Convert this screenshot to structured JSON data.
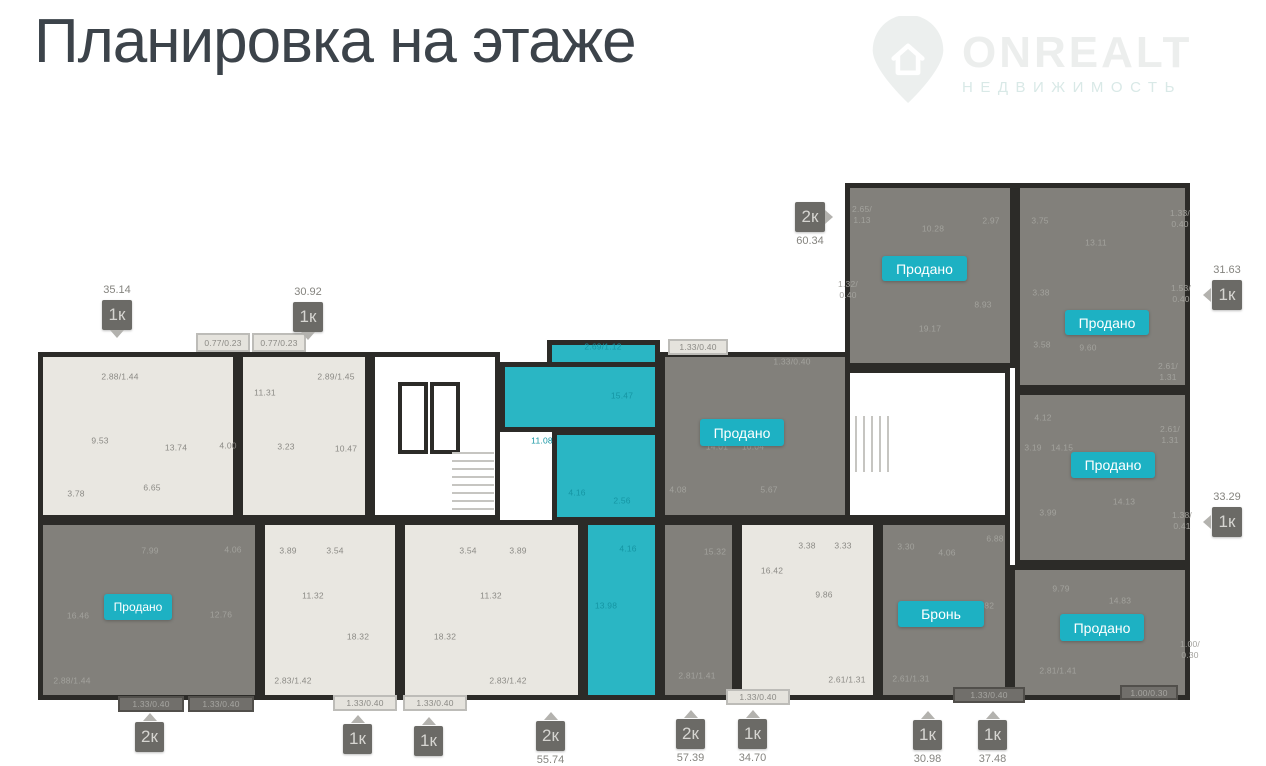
{
  "header": {
    "title": "Планировка на этаже"
  },
  "logo": {
    "brand": "ONREALT",
    "subtitle": "НЕДВИЖИМОСТЬ",
    "icon": "house-pin-icon"
  },
  "palette": {
    "accent_teal": "#1db1c3",
    "apartment_highlight": "#2ab6c4",
    "wall": "#2c2b28",
    "apartment_light": "#e9e7e1",
    "apartment_sold": "#82807b",
    "badge_dark": "#6b6a66",
    "title_color": "#3c434a"
  },
  "plan": {
    "blocks": [
      {
        "n": "apartment-1k-35-14",
        "f": "light",
        "i": 1,
        "x": 38,
        "y": 352,
        "w": 200,
        "h": 168
      },
      {
        "n": "apartment-1k-30-92",
        "f": "light",
        "i": 1,
        "x": 238,
        "y": 352,
        "w": 132,
        "h": 168
      },
      {
        "n": "stairwell-left",
        "f": "white",
        "i": 0,
        "x": 370,
        "y": 352,
        "w": 130,
        "h": 168
      },
      {
        "n": "apartment-2k-57-39-upper",
        "f": "dark",
        "i": 1,
        "x": 660,
        "y": 352,
        "w": 190,
        "h": 168
      },
      {
        "n": "corridor-left",
        "f": "white",
        "i": 0,
        "x": 850,
        "y": 352,
        "w": 30,
        "h": 168
      },
      {
        "n": "apartment-2k-sold-bottom-left",
        "f": "dark",
        "i": 1,
        "x": 38,
        "y": 520,
        "w": 222,
        "h": 180
      },
      {
        "n": "apartment-1k-bottom-a",
        "f": "light",
        "i": 1,
        "x": 260,
        "y": 520,
        "w": 140,
        "h": 180
      },
      {
        "n": "apartment-1k-bottom-b",
        "f": "light",
        "i": 1,
        "x": 400,
        "y": 520,
        "w": 183,
        "h": 180
      },
      {
        "n": "apartment-2k-57-39-lower",
        "f": "dark",
        "i": 1,
        "x": 660,
        "y": 520,
        "w": 77,
        "h": 180
      },
      {
        "n": "apartment-1k-34-70",
        "f": "light",
        "i": 1,
        "x": 737,
        "y": 520,
        "w": 141,
        "h": 180
      },
      {
        "n": "apartment-2k-55-74-top",
        "f": "teal",
        "i": 1,
        "x": 547,
        "y": 340,
        "w": 113,
        "h": 34
      },
      {
        "n": "apartment-2k-55-74-upper",
        "f": "teal",
        "i": 1,
        "x": 500,
        "y": 362,
        "w": 160,
        "h": 70
      },
      {
        "n": "apartment-2k-55-74-mid",
        "f": "teal",
        "i": 1,
        "x": 552,
        "y": 430,
        "w": 108,
        "h": 92
      },
      {
        "n": "apartment-2k-55-74-lower",
        "f": "teal",
        "i": 1,
        "x": 583,
        "y": 520,
        "w": 77,
        "h": 180
      },
      {
        "n": "apartment-2k-60-34",
        "f": "dark",
        "i": 1,
        "x": 845,
        "y": 183,
        "w": 170,
        "h": 185
      },
      {
        "n": "stairwell-right",
        "f": "white",
        "i": 0,
        "x": 845,
        "y": 368,
        "w": 165,
        "h": 152
      },
      {
        "n": "apartment-1k-31-63",
        "f": "dark",
        "i": 1,
        "x": 1015,
        "y": 183,
        "w": 175,
        "h": 207
      },
      {
        "n": "apartment-1k-33-29",
        "f": "dark",
        "i": 1,
        "x": 1015,
        "y": 390,
        "w": 175,
        "h": 175
      },
      {
        "n": "apartment-1k-30-98-reserved",
        "f": "dark",
        "i": 1,
        "x": 878,
        "y": 520,
        "w": 132,
        "h": 180
      },
      {
        "n": "apartment-1k-37-48",
        "f": "dark",
        "i": 1,
        "x": 1010,
        "y": 565,
        "w": 180,
        "h": 135
      }
    ],
    "balcony_boxes": [
      {
        "t": "0.77/0.23",
        "f": "lightbox",
        "x": 196,
        "y": 333,
        "w": 54,
        "h": 19
      },
      {
        "t": "0.77/0.23",
        "f": "lightbox",
        "x": 252,
        "y": 333,
        "w": 54,
        "h": 19
      },
      {
        "t": "1.33/0.40",
        "f": "lightbox",
        "x": 668,
        "y": 339,
        "w": 60,
        "h": 16
      },
      {
        "t": "1.33/0.40",
        "f": "darkbox",
        "x": 118,
        "y": 696,
        "w": 66,
        "h": 16
      },
      {
        "t": "1.33/0.40",
        "f": "darkbox",
        "x": 188,
        "y": 696,
        "w": 66,
        "h": 16
      },
      {
        "t": "1.33/0.40",
        "f": "lightbox",
        "x": 333,
        "y": 695,
        "w": 64,
        "h": 16
      },
      {
        "t": "1.33/0.40",
        "f": "lightbox",
        "x": 403,
        "y": 695,
        "w": 64,
        "h": 16
      },
      {
        "t": "1.33/0.40",
        "f": "lightbox",
        "x": 726,
        "y": 689,
        "w": 64,
        "h": 16
      },
      {
        "t": "1.33/0.40",
        "f": "darkbox",
        "x": 953,
        "y": 687,
        "w": 72,
        "h": 16
      },
      {
        "t": "1.00/0.30",
        "f": "darkbox",
        "x": 1120,
        "y": 685,
        "w": 58,
        "h": 15
      }
    ],
    "rooms": [
      {
        "t": "2.88/1.44",
        "x": 120,
        "y": 377,
        "tn": "d"
      },
      {
        "t": "9.53",
        "x": 100,
        "y": 441,
        "tn": "d"
      },
      {
        "t": "13.74",
        "x": 176,
        "y": 448,
        "tn": "d"
      },
      {
        "t": "3.78",
        "x": 76,
        "y": 494,
        "tn": "d"
      },
      {
        "t": "6.65",
        "x": 152,
        "y": 488,
        "tn": "d"
      },
      {
        "t": "11.31",
        "x": 265,
        "y": 393,
        "tn": "d"
      },
      {
        "t": "4.00",
        "x": 228,
        "y": 446,
        "tn": "d"
      },
      {
        "t": "3.23",
        "x": 286,
        "y": 447,
        "tn": "d"
      },
      {
        "t": "2.89/1.45",
        "x": 336,
        "y": 377,
        "tn": "d"
      },
      {
        "t": "10.47",
        "x": 346,
        "y": 449,
        "tn": "d"
      },
      {
        "t": "16.46",
        "x": 78,
        "y": 616,
        "tn": "l"
      },
      {
        "t": "7.99",
        "x": 150,
        "y": 551,
        "tn": "l"
      },
      {
        "t": "12.76",
        "x": 221,
        "y": 615,
        "tn": "l"
      },
      {
        "t": "4.06",
        "x": 233,
        "y": 550,
        "tn": "l"
      },
      {
        "t": "2.88/1.44",
        "x": 72,
        "y": 681,
        "tn": "l"
      },
      {
        "t": "3.89",
        "x": 288,
        "y": 551,
        "tn": "d"
      },
      {
        "t": "3.54",
        "x": 335,
        "y": 551,
        "tn": "d"
      },
      {
        "t": "11.32",
        "x": 313,
        "y": 596,
        "tn": "d"
      },
      {
        "t": "18.32",
        "x": 358,
        "y": 637,
        "tn": "d"
      },
      {
        "t": "2.83/1.42",
        "x": 293,
        "y": 681,
        "tn": "d"
      },
      {
        "t": "3.54",
        "x": 468,
        "y": 551,
        "tn": "d"
      },
      {
        "t": "3.89",
        "x": 518,
        "y": 551,
        "tn": "d"
      },
      {
        "t": "11.32",
        "x": 491,
        "y": 596,
        "tn": "d"
      },
      {
        "t": "18.32",
        "x": 445,
        "y": 637,
        "tn": "d"
      },
      {
        "t": "2.83/1.42",
        "x": 508,
        "y": 681,
        "tn": "d"
      },
      {
        "t": "2.69/1.12",
        "x": 603,
        "y": 347,
        "tn": "t"
      },
      {
        "t": "15.47",
        "x": 622,
        "y": 396,
        "tn": "t"
      },
      {
        "t": "11.08",
        "x": 542,
        "y": 441,
        "tn": "t"
      },
      {
        "t": "4.16",
        "x": 577,
        "y": 493,
        "tn": "t"
      },
      {
        "t": "2.56",
        "x": 622,
        "y": 501,
        "tn": "t"
      },
      {
        "t": "4.16",
        "x": 628,
        "y": 549,
        "tn": "t"
      },
      {
        "t": "13.98",
        "x": 606,
        "y": 606,
        "tn": "t"
      },
      {
        "t": "1.33/0.40",
        "x": 792,
        "y": 362,
        "tn": "l"
      },
      {
        "t": "14.01",
        "x": 717,
        "y": 447,
        "tn": "l"
      },
      {
        "t": "10.04",
        "x": 753,
        "y": 447,
        "tn": "l"
      },
      {
        "t": "4.08",
        "x": 678,
        "y": 490,
        "tn": "l"
      },
      {
        "t": "5.67",
        "x": 769,
        "y": 490,
        "tn": "l"
      },
      {
        "t": "15.32",
        "x": 715,
        "y": 552,
        "tn": "l"
      },
      {
        "t": "2.81/1.41",
        "x": 697,
        "y": 676,
        "tn": "l"
      },
      {
        "t": "3.38",
        "x": 807,
        "y": 546,
        "tn": "d"
      },
      {
        "t": "3.33",
        "x": 843,
        "y": 546,
        "tn": "d"
      },
      {
        "t": "16.42",
        "x": 772,
        "y": 571,
        "tn": "d"
      },
      {
        "t": "9.86",
        "x": 824,
        "y": 595,
        "tn": "d"
      },
      {
        "t": "2.61/1.31",
        "x": 847,
        "y": 680,
        "tn": "d"
      },
      {
        "t": "2.65/\n1.13",
        "x": 862,
        "y": 215,
        "tn": "l"
      },
      {
        "t": "10.28",
        "x": 933,
        "y": 229,
        "tn": "l"
      },
      {
        "t": "2.97",
        "x": 991,
        "y": 221,
        "tn": "l"
      },
      {
        "t": "1.32/\n0.40",
        "x": 848,
        "y": 290,
        "tn": "l"
      },
      {
        "t": "8.93",
        "x": 983,
        "y": 305,
        "tn": "l"
      },
      {
        "t": "19.17",
        "x": 930,
        "y": 329,
        "tn": "l"
      },
      {
        "t": "3.75",
        "x": 1040,
        "y": 221,
        "tn": "l"
      },
      {
        "t": "13.11",
        "x": 1096,
        "y": 243,
        "tn": "l"
      },
      {
        "t": "1.33/\n0.40",
        "x": 1180,
        "y": 219,
        "tn": "l"
      },
      {
        "t": "3.38",
        "x": 1041,
        "y": 293,
        "tn": "l"
      },
      {
        "t": "1.53/\n0.40",
        "x": 1181,
        "y": 294,
        "tn": "l"
      },
      {
        "t": "3.58",
        "x": 1042,
        "y": 345,
        "tn": "l"
      },
      {
        "t": "9.60",
        "x": 1088,
        "y": 348,
        "tn": "l"
      },
      {
        "t": "2.61/\n1.31",
        "x": 1168,
        "y": 372,
        "tn": "l"
      },
      {
        "t": "4.12",
        "x": 1043,
        "y": 418,
        "tn": "l"
      },
      {
        "t": "3.19",
        "x": 1033,
        "y": 448,
        "tn": "l"
      },
      {
        "t": "14.15",
        "x": 1062,
        "y": 448,
        "tn": "l"
      },
      {
        "t": "2.61/\n1.31",
        "x": 1170,
        "y": 435,
        "tn": "l"
      },
      {
        "t": "14.13",
        "x": 1124,
        "y": 502,
        "tn": "l"
      },
      {
        "t": "3.99",
        "x": 1048,
        "y": 513,
        "tn": "l"
      },
      {
        "t": "1.38/\n0.41",
        "x": 1182,
        "y": 521,
        "tn": "l"
      },
      {
        "t": "3.30",
        "x": 906,
        "y": 547,
        "tn": "l"
      },
      {
        "t": "4.06",
        "x": 947,
        "y": 553,
        "tn": "l"
      },
      {
        "t": "13.82",
        "x": 983,
        "y": 606,
        "tn": "l"
      },
      {
        "t": "2.61/1.31",
        "x": 911,
        "y": 679,
        "tn": "l"
      },
      {
        "t": "6.88",
        "x": 995,
        "y": 539,
        "tn": "l"
      },
      {
        "t": "9.79",
        "x": 1061,
        "y": 589,
        "tn": "l"
      },
      {
        "t": "14.83",
        "x": 1120,
        "y": 601,
        "tn": "l"
      },
      {
        "t": "2.81/1.41",
        "x": 1058,
        "y": 671,
        "tn": "l"
      },
      {
        "t": "1.00/\n0.30",
        "x": 1190,
        "y": 650,
        "tn": "l"
      }
    ],
    "status_badges": [
      {
        "label": "Продано",
        "x": 882,
        "y": 256,
        "w": 85,
        "h": 25,
        "fs": 14
      },
      {
        "label": "Продано",
        "x": 1065,
        "y": 310,
        "w": 84,
        "h": 25,
        "fs": 14
      },
      {
        "label": "Продано",
        "x": 1071,
        "y": 452,
        "w": 84,
        "h": 26,
        "fs": 14
      },
      {
        "label": "Продано",
        "x": 700,
        "y": 419,
        "w": 84,
        "h": 27,
        "fs": 14
      },
      {
        "label": "Продано",
        "x": 104,
        "y": 594,
        "w": 68,
        "h": 26,
        "fs": 12
      },
      {
        "label": "Продано",
        "x": 1060,
        "y": 614,
        "w": 84,
        "h": 27,
        "fs": 14
      },
      {
        "label": "Бронь",
        "x": 898,
        "y": 601,
        "w": 86,
        "h": 26,
        "fs": 14
      }
    ],
    "unit_badges": [
      {
        "label": "1к",
        "area": "35.14",
        "side": "top",
        "ptr": "down",
        "x": 102,
        "y": 300,
        "w": 30,
        "h": 30
      },
      {
        "label": "1к",
        "area": "30.92",
        "side": "top",
        "ptr": "down",
        "x": 293,
        "y": 302,
        "w": 30,
        "h": 30
      },
      {
        "label": "2к",
        "area": "60.34",
        "side": "bottom",
        "ptr": "right",
        "x": 795,
        "y": 202,
        "w": 30,
        "h": 30
      },
      {
        "label": "1к",
        "area": "31.63",
        "side": "top",
        "ptr": "left",
        "x": 1212,
        "y": 280,
        "w": 30,
        "h": 30
      },
      {
        "label": "1к",
        "area": "33.29",
        "side": "top",
        "ptr": "left",
        "x": 1212,
        "y": 507,
        "w": 30,
        "h": 30
      },
      {
        "label": "2к",
        "area": "",
        "side": "bottom",
        "ptr": "up",
        "x": 135,
        "y": 722,
        "w": 29,
        "h": 30
      },
      {
        "label": "1к",
        "area": "",
        "side": "bottom",
        "ptr": "up",
        "x": 343,
        "y": 724,
        "w": 29,
        "h": 30
      },
      {
        "label": "1к",
        "area": "",
        "side": "bottom",
        "ptr": "up",
        "x": 414,
        "y": 726,
        "w": 29,
        "h": 30
      },
      {
        "label": "2к",
        "area": "55.74",
        "side": "bottom",
        "ptr": "up",
        "x": 536,
        "y": 721,
        "w": 29,
        "h": 30
      },
      {
        "label": "2к",
        "area": "57.39",
        "side": "bottom",
        "ptr": "up",
        "x": 676,
        "y": 719,
        "w": 29,
        "h": 30
      },
      {
        "label": "1к",
        "area": "34.70",
        "side": "bottom",
        "ptr": "up",
        "x": 738,
        "y": 719,
        "w": 29,
        "h": 30
      },
      {
        "label": "1к",
        "area": "30.98",
        "side": "bottom",
        "ptr": "up",
        "x": 913,
        "y": 720,
        "w": 29,
        "h": 30
      },
      {
        "label": "1к",
        "area": "37.48",
        "side": "bottom",
        "ptr": "up",
        "x": 978,
        "y": 720,
        "w": 29,
        "h": 30
      }
    ]
  }
}
